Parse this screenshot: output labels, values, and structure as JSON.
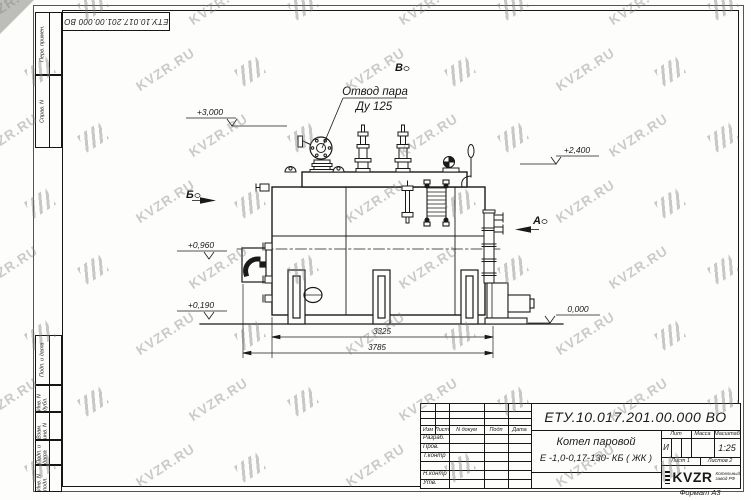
{
  "designation": "ЕТУ.10.017.201.00.000  ВО",
  "format_label": "Формат А3",
  "watermark": {
    "text": "KVZR.RU"
  },
  "margin": {
    "top": [
      "Перв. примен.",
      "Справ. N"
    ],
    "bottom": [
      "Подп. и дата",
      "Инв. N дубл.",
      "Взам. инв. N",
      "Подп. и дата",
      "Инв. N подл."
    ]
  },
  "drawing": {
    "annotation_line1": "Отвод пара",
    "annotation_line2": "Ду 125",
    "elevations": {
      "e3000": "+3,000",
      "e2400": "+2,400",
      "e0960": "+0,960",
      "e0190": "+0,190",
      "e0000": "0,000"
    },
    "sections": {
      "a": "А",
      "b": "Б",
      "v": "В"
    },
    "dimensions": {
      "d3325": "3325",
      "d3785": "3785"
    }
  },
  "title_block": {
    "name_line1": "Котел паровой",
    "name_line2": "Е -1,0-0,17-130- КБ ( ЖК )",
    "header_cols": [
      "Изм",
      "Лист",
      "N докум",
      "Подп",
      "Дата"
    ],
    "rows": [
      "Разраб.",
      "Пров.",
      "Т.контр",
      "",
      "Н.контр",
      "Утв."
    ],
    "lit_header": "Лит",
    "mass_header": "Масса",
    "scale_header": "Масштаб",
    "lit_value": "И",
    "scale_value": "1:25",
    "sheet_label": "Лист 1",
    "sheets_label": "Листов 2",
    "logo_text": "KVZR",
    "logo_sub1": "Котельный",
    "logo_sub2": "завод РФ"
  }
}
